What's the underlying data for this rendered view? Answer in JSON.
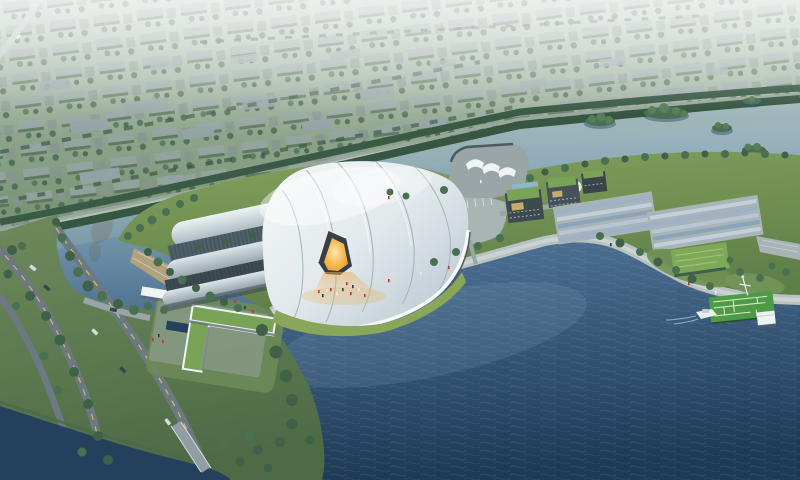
{
  "scene": {
    "kind": "aerial-architectural-rendering",
    "subject": "lakeside exhibition-stadium complex with white shell roofs, waterfront promenade, office cluster, maze pier and surrounding low-rise city",
    "visible_text": ""
  },
  "palette": {
    "haze_top": "#d8e0d8",
    "haze_mid": "#a8bbae",
    "city_green": "#74906f",
    "city_block": "#93a2a4",
    "belt_green": "#3a5a45",
    "belt_road": "#9aa79e",
    "water_light": "#a7bcc3",
    "water_mid": "#7d9fb2",
    "water_deep": "#44678a",
    "water_darkest": "#22405e",
    "deep_top": "#4f7396",
    "deep_bottom": "#1f3a57",
    "channel_dark": "#24405d",
    "island_green": "#4a6e51",
    "island_light": "#567e58",
    "land_green": "#6e8a5c",
    "land_green_dark": "#4e6b46",
    "site_lawn": "#84a15c",
    "site_lawn_dark": "#5f7f49",
    "lawn_bright": "#8aa659",
    "shell_white": "#f5f8f8",
    "shell_shade": "#bfccd4",
    "seam_gray": "#9fb0b8",
    "vault_glass": "#4f6069",
    "vault_glass_dark": "#3c4a52",
    "fascia_white": "#f4f8f8",
    "glass_line": "#4a575f",
    "entrance_dark": "#343f46",
    "glow_core": "#ffe7b0",
    "glow_edge": "#e8972e",
    "spill_orange": "#f0b050",
    "plaza_gray": "#a9b4b5",
    "promenade": "#b9c2c2",
    "promenade_light": "#cdd5d5",
    "step_edge": "#8f9a9d",
    "road_dark": "#6d7982",
    "road_light": "#9aa5a7",
    "road_line_yellow": "#d4c05c",
    "rail_white": "#d9dfe0",
    "green_roof": "#79a458",
    "roof_tan": "#c5ab6d",
    "dark_building": "#3e4950",
    "panel_a": "#9cb2c8",
    "panel_b": "#c2cfdc",
    "pool_blue": "#90b5c3",
    "tan_terrace": "#b2a179",
    "pier_green": "#4d9a47",
    "maze_line": "#d9e5c4",
    "white_structure": "#eef3f3",
    "boat_white": "#e9efef",
    "tree_dark": "#3f6148",
    "tree_mid": "#4a7052",
    "tree_belt_row": "#365641",
    "people_red": "#b83b2c",
    "people_white": "#e8ecec",
    "people_dark": "#2e3b44",
    "car_dark": "#39454d",
    "car_light": "#d8dcdd",
    "bank_green": "#4a6a49",
    "bridge_deck": "#929da3",
    "sheen": "#8fb0c4"
  }
}
